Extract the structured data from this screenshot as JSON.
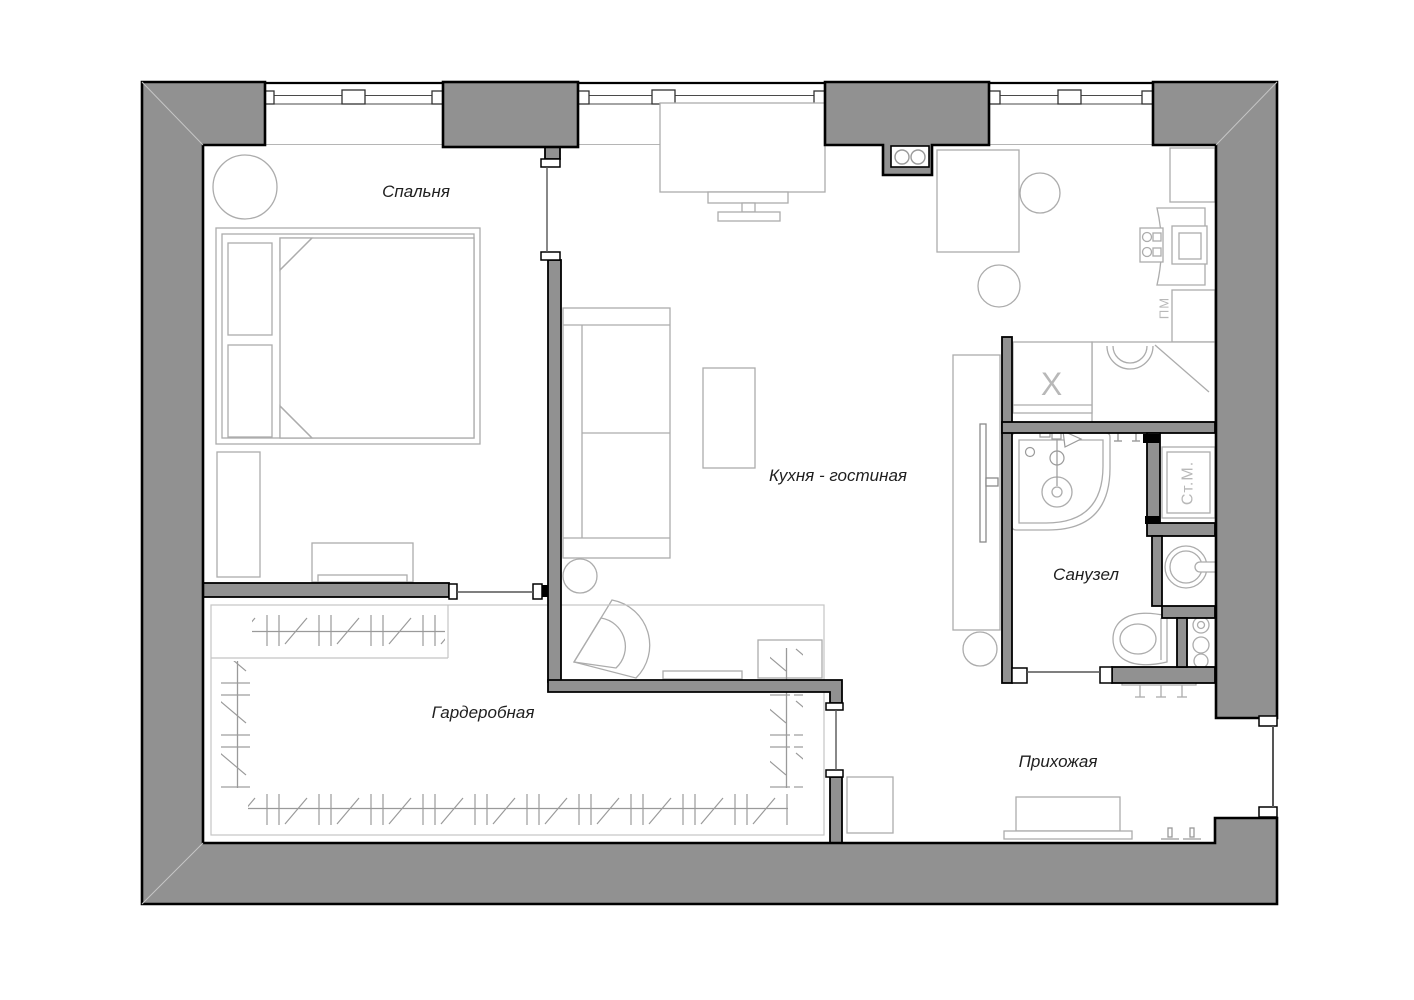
{
  "floorplan": {
    "background": "#ffffff",
    "wall_color": "#919191",
    "outline_color": "#000000",
    "furniture_color": "#acacac",
    "rooms": [
      {
        "id": "bedroom",
        "label": "Спальня"
      },
      {
        "id": "kitchen_living",
        "label": "Кухня - гостиная"
      },
      {
        "id": "wardrobe",
        "label": "Гардеробная"
      },
      {
        "id": "bathroom",
        "label": "Санузел"
      },
      {
        "id": "hallway",
        "label": "Прихожая"
      }
    ],
    "appliance_labels": {
      "washing_machine": "Ст.М.",
      "fridge": "X",
      "dishwasher": "ПМ"
    }
  }
}
